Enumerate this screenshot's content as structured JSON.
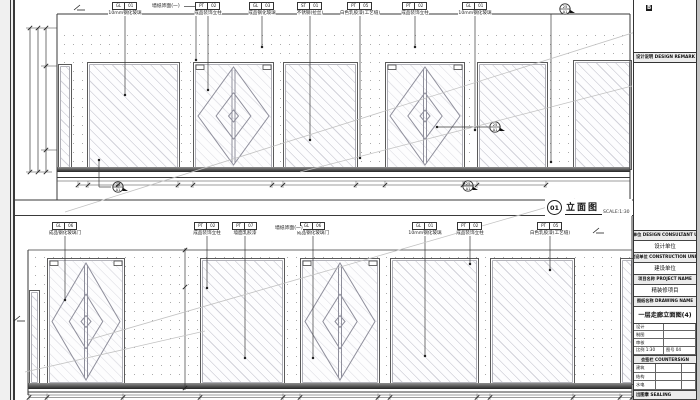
{
  "colors": {
    "line": "#3a3a3a",
    "light_line": "#c2c2c2",
    "hatch": "#d2d2da",
    "dots": "#ababab",
    "paper": "#ffffff"
  },
  "drawing_title": {
    "num": "01",
    "name": "立面图",
    "scale": "SCALE:1:30"
  },
  "title_block": {
    "top_mark": "B",
    "remark_header": "设计说明 DESIGN REMARK",
    "rows": [
      {
        "label": "设计单位 DESIGN CONSULTANT UNIT",
        "value": "设计单位"
      },
      {
        "label": "建设单位 CONSTRUCTION UNIT",
        "value": "建设单位"
      },
      {
        "label": "项目名称 PROJECT NAME",
        "value": "精装修项目"
      },
      {
        "label": "图纸名称 DRAWING NAME",
        "value": ""
      }
    ],
    "drawing_name": "一层走廊立面图(4)",
    "info_table": [
      [
        "设计",
        ""
      ],
      [
        "制图",
        ""
      ],
      [
        "审核",
        ""
      ],
      [
        "比例 1:30",
        "图号 04"
      ]
    ],
    "countersign_header": "会签栏 COUNTERSIGN",
    "countersign_rows": [
      [
        "建筑",
        ""
      ],
      [
        "结构",
        ""
      ],
      [
        "水电",
        ""
      ]
    ],
    "sealing": "出图章 SEALING"
  },
  "elevations": [
    {
      "id": "top",
      "frame": {
        "x1": 57,
        "y1": 14,
        "x2": 630,
        "y2": 200
      },
      "wall": {
        "x": 57,
        "y": 28,
        "w": 573,
        "h": 140
      },
      "baseboard": {
        "x": 57,
        "y": 167,
        "w": 573,
        "h": 5
      },
      "floorlines": [
        177.5,
        181
      ],
      "panels": [
        {
          "t": "sliver",
          "x": 58,
          "y": 64,
          "w": 12,
          "h": 104
        },
        {
          "t": "glass",
          "x": 87,
          "y": 62,
          "w": 91,
          "h": 106
        },
        {
          "t": "door",
          "x": 193,
          "y": 62,
          "w": 79,
          "h": 106
        },
        {
          "t": "glass",
          "x": 283,
          "y": 62,
          "w": 73,
          "h": 106
        },
        {
          "t": "door",
          "x": 385,
          "y": 62,
          "w": 78,
          "h": 106
        },
        {
          "t": "glass",
          "x": 477,
          "y": 62,
          "w": 69,
          "h": 106
        },
        {
          "t": "glass",
          "x": 573,
          "y": 60,
          "w": 57,
          "h": 108
        }
      ],
      "tags": [
        {
          "x": 125,
          "boxY": 2,
          "codes": [
            "GL",
            "01"
          ],
          "label": "10mm钢化玻璃",
          "dotY": 95
        },
        {
          "x": 208,
          "boxY": 2,
          "codes": [
            "PT",
            "02"
          ],
          "label": "成品装饰立柱",
          "dotY": 90
        },
        {
          "x": 262,
          "boxY": 2,
          "codes": [
            "GL",
            "03"
          ],
          "label": "成品钢化玻璃",
          "dotY": 47
        },
        {
          "x": 310,
          "boxY": 2,
          "codes": [
            "ST",
            "01"
          ],
          "label": "不锈钢(拉丝)",
          "dotY": 140
        },
        {
          "x": 360,
          "boxY": 2,
          "codes": [
            "PT",
            "05"
          ],
          "label": "白色乳胶漆(工艺缝)",
          "dotY": 158
        },
        {
          "x": 415,
          "boxY": 2,
          "codes": [
            "PT",
            "02"
          ],
          "label": "成品装饰立柱",
          "dotY": 47
        },
        {
          "x": 475,
          "boxY": 2,
          "codes": [
            "GL",
            "01"
          ],
          "label": "10mm钢化玻璃",
          "dotY": 130
        }
      ],
      "text_callouts": [
        {
          "x": 152,
          "y": 4,
          "text": "墙纸饰面(一)",
          "elbowX": 196,
          "dotY": 60
        }
      ],
      "markers": [
        {
          "x": 565,
          "y": 9,
          "top": "25",
          "bottom": "A1"
        },
        {
          "x": 495,
          "y": 127,
          "top": "25",
          "bottom": "A1",
          "leader": [
            [
              437,
              127
            ],
            [
              489,
              127
            ]
          ]
        },
        {
          "x": 118,
          "y": 187,
          "top": "25",
          "bottom": "A1",
          "leader": [
            [
              99,
              160
            ],
            [
              99,
              187
            ],
            [
              111,
              187
            ]
          ]
        },
        {
          "x": 468,
          "y": 186,
          "top": "25",
          "bottom": "A1"
        }
      ],
      "left_chain": {
        "xs": [
          30,
          38,
          46
        ],
        "y1": 28,
        "y2": 172,
        "midTicks": [
          66,
          150
        ]
      },
      "bottom_dim": {
        "y": 185,
        "x1": 78,
        "x2": 546,
        "ticks": [
          78,
          88,
          118,
          178,
          193,
          272,
          283,
          356,
          385,
          463,
          477,
          546
        ]
      },
      "refline": {
        "x": 551,
        "y1": 14,
        "y2": 162
      }
    },
    {
      "id": "bottom",
      "frame": {
        "x1": 28,
        "y1": 215.5,
        "x2": 632,
        "y2": 400
      },
      "wall": {
        "x": 28,
        "y": 250,
        "w": 604,
        "h": 135
      },
      "baseboard": {
        "x": 28,
        "y": 383,
        "w": 604,
        "h": 5.5
      },
      "floorlines": [
        392,
        395
      ],
      "panels": [
        {
          "t": "sliver",
          "x": 29,
          "y": 290,
          "w": 9,
          "h": 93
        },
        {
          "t": "door",
          "x": 47,
          "y": 258,
          "w": 76,
          "h": 125
        },
        {
          "t": "glass",
          "x": 200,
          "y": 258,
          "w": 83,
          "h": 125
        },
        {
          "t": "door",
          "x": 300,
          "y": 258,
          "w": 78,
          "h": 125
        },
        {
          "t": "glass",
          "x": 390,
          "y": 258,
          "w": 87,
          "h": 125
        },
        {
          "t": "glass",
          "x": 490,
          "y": 258,
          "w": 83,
          "h": 125
        },
        {
          "t": "glass",
          "x": 620,
          "y": 258,
          "w": 12,
          "h": 125
        }
      ],
      "tags": [
        {
          "x": 65,
          "boxY": 222,
          "codes": [
            "GL",
            "06"
          ],
          "label": "成品钢化玻璃门",
          "dotY": 300
        },
        {
          "x": 207,
          "boxY": 222,
          "codes": [
            "PT",
            "02"
          ],
          "label": "成品装饰立柱",
          "dotY": 288
        },
        {
          "x": 245,
          "boxY": 222,
          "codes": [
            "PT",
            "07"
          ],
          "label": "墙面乳胶漆",
          "dotY": 358
        },
        {
          "x": 313,
          "boxY": 222,
          "codes": [
            "GL",
            "06"
          ],
          "label": "成品钢化玻璃门",
          "dotY": 358
        },
        {
          "x": 425,
          "boxY": 222,
          "codes": [
            "GL",
            "01"
          ],
          "label": "10mm钢化玻璃",
          "dotY": 356
        },
        {
          "x": 470,
          "boxY": 222,
          "codes": [
            "PT",
            "02"
          ],
          "label": "成品装饰立柱",
          "dotY": 264
        },
        {
          "x": 550,
          "boxY": 222,
          "codes": [
            "PT",
            "05"
          ],
          "label": "白色乳胶漆(工艺缝)",
          "dotY": 270
        }
      ],
      "text_callouts": [
        {
          "x": 275,
          "y": 226,
          "text": "墙纸饰面(一)",
          "elbowX": 313,
          "dotY": 0
        }
      ],
      "markers": [],
      "mid_chain": {
        "x": 185,
        "y1": 248,
        "y2": 390,
        "ticks": [
          250,
          287,
          388
        ]
      },
      "bottom_dim": {
        "y": 397.5,
        "x1": 29,
        "x2": 632,
        "ticks": [
          29,
          47,
          123,
          200,
          283,
          300,
          378,
          390,
          477,
          490,
          573,
          620,
          632
        ]
      }
    }
  ],
  "diagonals": [
    [
      65,
      212,
      648,
      28
    ],
    [
      300,
      172,
      632,
      86
    ],
    [
      88,
      340,
      575,
      199
    ],
    [
      25,
      372,
      205,
      331
    ]
  ],
  "axis_marks": [
    [
      78,
      7
    ],
    [
      597,
      230
    ],
    [
      18,
      318
    ]
  ]
}
